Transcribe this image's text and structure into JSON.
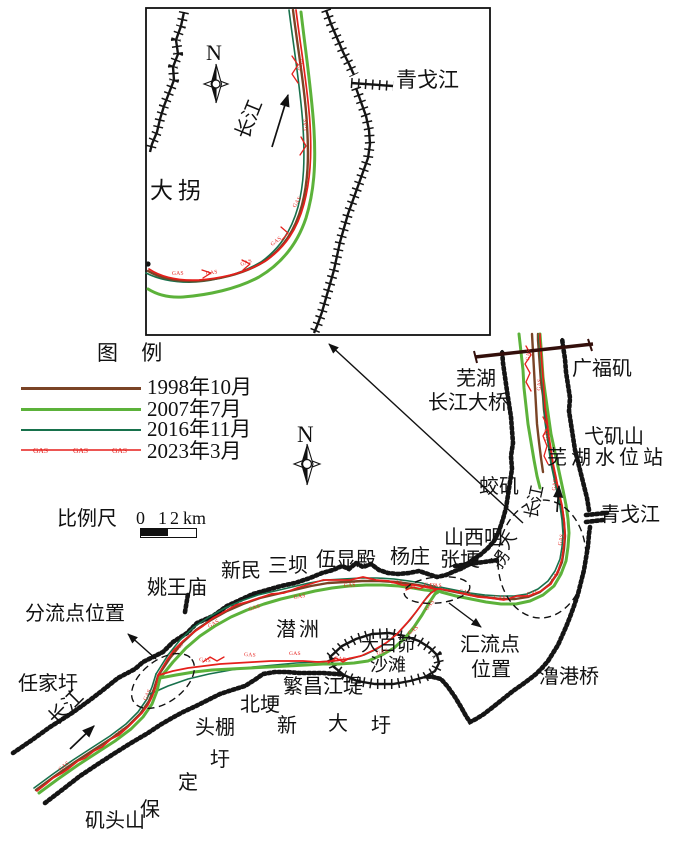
{
  "colors": {
    "y1998": "#7a4426",
    "y2007": "#5cb23a",
    "y2016": "#17714c",
    "y2023": "#e51f1b",
    "bank": "#151515",
    "bridge": "#330f0b",
    "ink": "#111111"
  },
  "legend": {
    "title": "图 例",
    "gas_marker": "GAS",
    "items": [
      {
        "label": "1998年10月",
        "color": "#7a4426",
        "style": "solid"
      },
      {
        "label": "2007年7月",
        "color": "#5cb23a",
        "style": "solid"
      },
      {
        "label": "2016年11月",
        "color": "#17714c",
        "style": "solid"
      },
      {
        "label": "2023年3月",
        "color": "#e51f1b",
        "style": "gas-line"
      }
    ]
  },
  "scale": {
    "label": "比例尺",
    "t0": "0",
    "t1": "1",
    "t2": "2",
    "unit": "km"
  },
  "compass": {
    "n": "N"
  },
  "map_labels": [
    {
      "id": "inset-qinggejiang",
      "t": "青戈江",
      "x": 396,
      "y": 70,
      "s": 21
    },
    {
      "id": "inset-daguai",
      "t": "大拐",
      "x": 150,
      "y": 179,
      "s": 23,
      "ls": 5
    },
    {
      "id": "inset-changjiang",
      "t": "长江",
      "x": 242,
      "y": 128,
      "s": 20,
      "rot": -68
    },
    {
      "id": "wuhu",
      "t": "芜湖",
      "x": 456,
      "y": 369,
      "s": 20
    },
    {
      "id": "changjiang-daqiao",
      "t": "长江大桥",
      "x": 428,
      "y": 393,
      "s": 20
    },
    {
      "id": "guangfuji",
      "t": "广福矶",
      "x": 572,
      "y": 359,
      "s": 20
    },
    {
      "id": "yijishan",
      "t": "弋矶山",
      "x": 584,
      "y": 427,
      "s": 20
    },
    {
      "id": "wuhu-shuiweizhan",
      "t": "芜湖水位站",
      "x": 547,
      "y": 448,
      "s": 20,
      "ls": 4
    },
    {
      "id": "jiaoji",
      "t": "蛟矶",
      "x": 479,
      "y": 477,
      "s": 20
    },
    {
      "id": "qinggejiang",
      "t": "青戈江",
      "x": 600,
      "y": 505,
      "s": 20
    },
    {
      "id": "shanxizui",
      "t": "山西咀",
      "x": 444,
      "y": 528,
      "s": 20
    },
    {
      "id": "zhanggeng",
      "t": "张埂",
      "x": 440,
      "y": 550,
      "s": 20
    },
    {
      "id": "changjiang-bend",
      "t": "长江",
      "x": 531,
      "y": 510,
      "s": 17,
      "rot": -78
    },
    {
      "id": "daguai-da",
      "t": "大",
      "x": 503,
      "y": 539,
      "s": 17,
      "rot": -55
    },
    {
      "id": "daguai-guai",
      "t": "拐",
      "x": 496,
      "y": 558,
      "s": 17,
      "rot": -55
    },
    {
      "id": "huiliudian",
      "t": "汇流点",
      "x": 460,
      "y": 635,
      "s": 20
    },
    {
      "id": "huiliu-weizhi",
      "t": "位置",
      "x": 471,
      "y": 660,
      "s": 20
    },
    {
      "id": "lugangqiao",
      "t": "澛港桥",
      "x": 539,
      "y": 667,
      "s": 20
    },
    {
      "id": "yaowangmiao",
      "t": "姚王庙",
      "x": 147,
      "y": 578,
      "s": 20
    },
    {
      "id": "xinmin",
      "t": "新民",
      "x": 221,
      "y": 561,
      "s": 20
    },
    {
      "id": "sanba",
      "t": "三坝",
      "x": 268,
      "y": 556,
      "s": 20
    },
    {
      "id": "wuxiandian",
      "t": "伍显殿",
      "x": 316,
      "y": 550,
      "s": 20
    },
    {
      "id": "yangzhuang",
      "t": "杨庄",
      "x": 390,
      "y": 547,
      "s": 20
    },
    {
      "id": "qianzhou",
      "t": "潜洲",
      "x": 276,
      "y": 620,
      "s": 20,
      "ls": 3
    },
    {
      "id": "dabaimao",
      "t": "大白茆",
      "x": 361,
      "y": 636,
      "s": 18
    },
    {
      "id": "shatan",
      "t": "沙滩",
      "x": 370,
      "y": 656,
      "s": 18
    },
    {
      "id": "fanchang-jiangdi",
      "t": "繁昌江堤",
      "x": 283,
      "y": 677,
      "s": 20
    },
    {
      "id": "beigeng",
      "t": "北埂",
      "x": 240,
      "y": 695,
      "s": 20
    },
    {
      "id": "xin",
      "t": "新",
      "x": 277,
      "y": 716,
      "s": 20
    },
    {
      "id": "da",
      "t": "大",
      "x": 328,
      "y": 714,
      "s": 20
    },
    {
      "id": "wei-1",
      "t": "圩",
      "x": 371,
      "y": 716,
      "s": 20
    },
    {
      "id": "toupeng",
      "t": "头棚",
      "x": 195,
      "y": 718,
      "s": 20
    },
    {
      "id": "wei-2",
      "t": "圩",
      "x": 210,
      "y": 750,
      "s": 20
    },
    {
      "id": "ding",
      "t": "定",
      "x": 178,
      "y": 773,
      "s": 20
    },
    {
      "id": "bao",
      "t": "保",
      "x": 140,
      "y": 800,
      "s": 20
    },
    {
      "id": "jitoushan",
      "t": "矶头山",
      "x": 85,
      "y": 811,
      "s": 20
    },
    {
      "id": "renjiawei",
      "t": "任家圩",
      "x": 18,
      "y": 674,
      "s": 20
    },
    {
      "id": "changjiang-sw",
      "t": "长江",
      "x": 52,
      "y": 712,
      "s": 20,
      "rot": -45
    },
    {
      "id": "fenliudian-weizhi",
      "t": "分流点位置",
      "x": 25,
      "y": 604,
      "s": 20
    }
  ],
  "gas_markers": [
    {
      "x": 301,
      "y": 68,
      "r": -82
    },
    {
      "x": 306,
      "y": 128,
      "r": -84
    },
    {
      "x": 295,
      "y": 205,
      "r": -58
    },
    {
      "x": 272,
      "y": 243,
      "r": -36
    },
    {
      "x": 241,
      "y": 263,
      "r": -20
    },
    {
      "x": 206,
      "y": 272,
      "r": -8
    },
    {
      "x": 172,
      "y": 272,
      "r": -2
    },
    {
      "x": 60,
      "y": 768,
      "r": -38
    },
    {
      "x": 116,
      "y": 735,
      "r": -42
    },
    {
      "x": 146,
      "y": 698,
      "r": -65
    },
    {
      "x": 175,
      "y": 650,
      "r": -45
    },
    {
      "x": 209,
      "y": 625,
      "r": -30
    },
    {
      "x": 249,
      "y": 608,
      "r": -18
    },
    {
      "x": 294,
      "y": 596,
      "r": -10
    },
    {
      "x": 344,
      "y": 584,
      "r": -4
    },
    {
      "x": 391,
      "y": 581,
      "r": 0
    },
    {
      "x": 424,
      "y": 583,
      "r": 6
    },
    {
      "x": 199,
      "y": 658,
      "r": 6
    },
    {
      "x": 244,
      "y": 653,
      "r": 3
    },
    {
      "x": 289,
      "y": 652,
      "r": 0
    },
    {
      "x": 334,
      "y": 657,
      "r": 4
    },
    {
      "x": 377,
      "y": 652,
      "r": -16
    },
    {
      "x": 409,
      "y": 632,
      "r": -36
    },
    {
      "x": 427,
      "y": 608,
      "r": -52
    },
    {
      "x": 405,
      "y": 586,
      "r": 0
    },
    {
      "x": 430,
      "y": 584,
      "r": 0
    },
    {
      "x": 459,
      "y": 590,
      "r": 5
    },
    {
      "x": 494,
      "y": 596,
      "r": 2
    },
    {
      "x": 527,
      "y": 593,
      "r": -12
    },
    {
      "x": 552,
      "y": 578,
      "r": -45
    },
    {
      "x": 561,
      "y": 543,
      "r": -78
    },
    {
      "x": 555,
      "y": 488,
      "r": -82
    },
    {
      "x": 547,
      "y": 438,
      "r": -84
    },
    {
      "x": 540,
      "y": 388,
      "r": -85
    },
    {
      "x": 529,
      "y": 358,
      "r": -85
    }
  ]
}
